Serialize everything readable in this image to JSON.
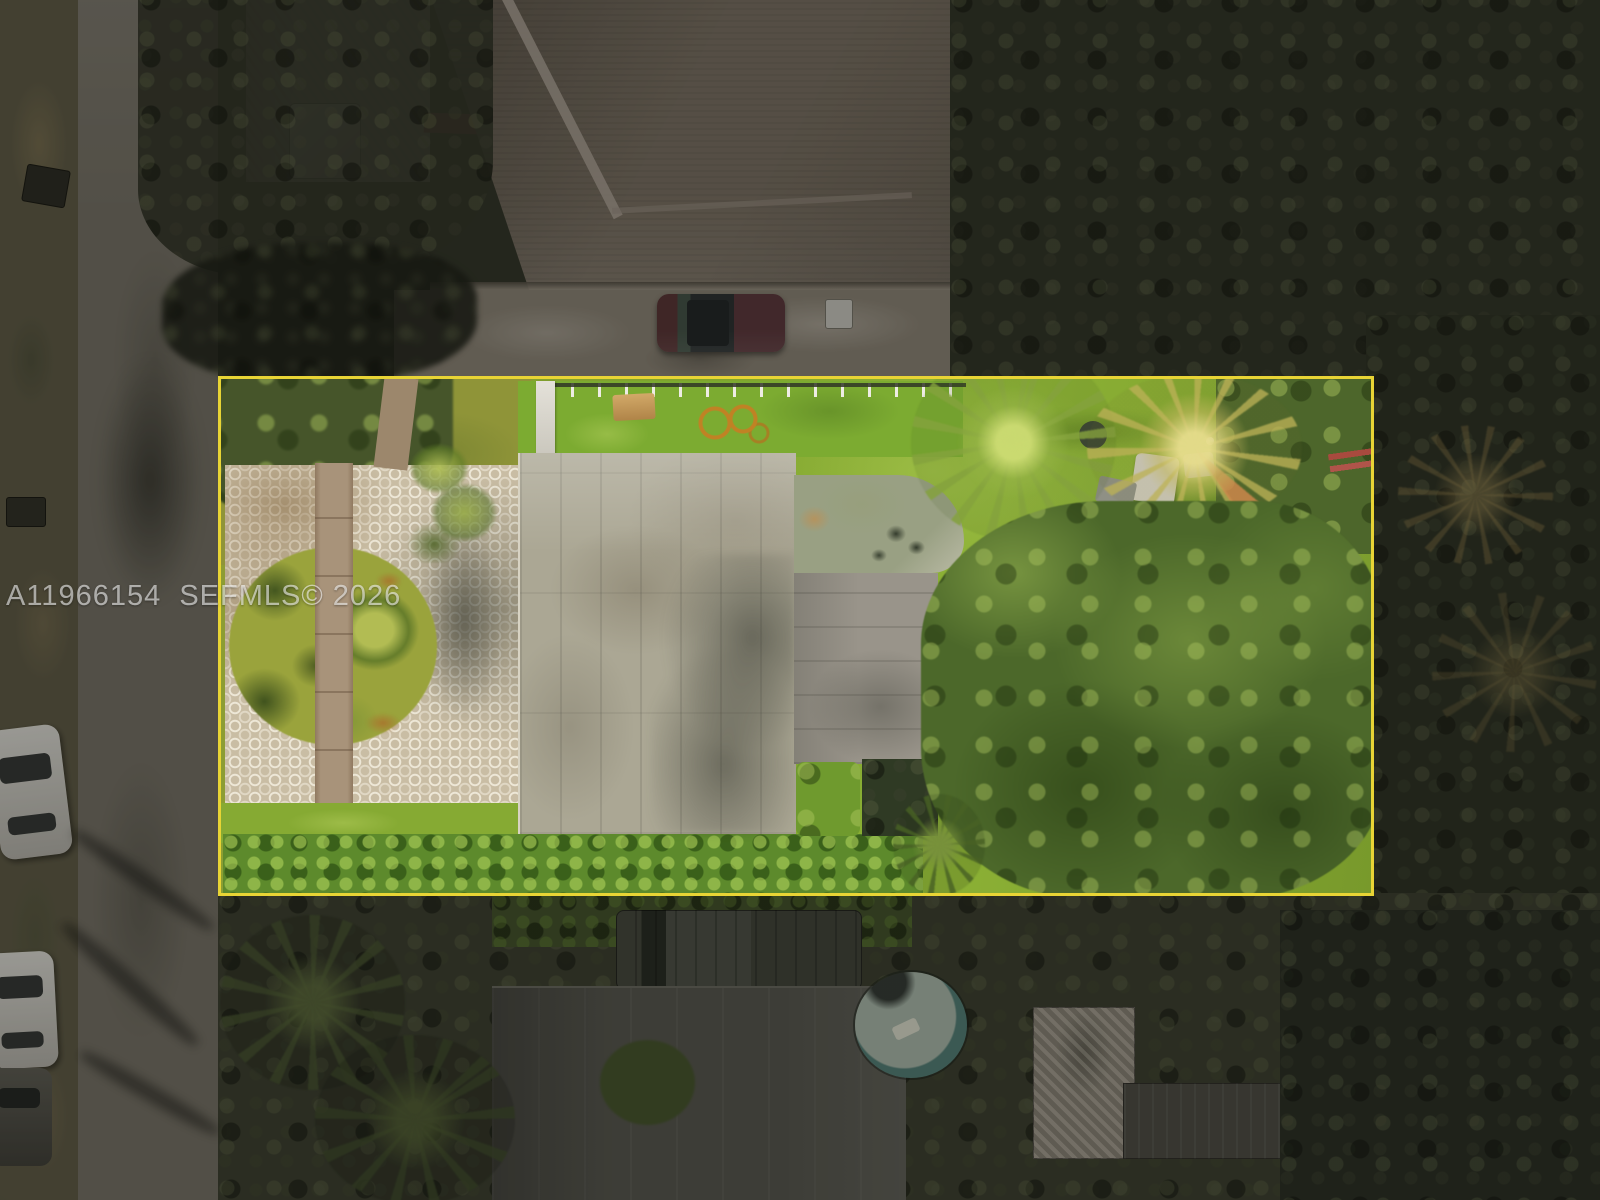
{
  "watermark": {
    "text": "A11966154  SEFMLS© 2026"
  },
  "palette": {
    "prop-line": "#e8d435",
    "watermark": "rgba(255,255,255,0.58)",
    "lawn": "#7fa42d",
    "canopy": "#4c682a",
    "island": "#9aa33c",
    "hedge": "#5d8a2c",
    "pavers": "#c9bda4",
    "walk": "#a8937a",
    "roof": "#aba794",
    "roof-shadow": "rgba(50,52,44,0.55)",
    "street": "#6a665c",
    "swale": "#56523f",
    "outside-trees": "#2b2e23",
    "top-roof": "#6e6559",
    "bottom-roof": "#4e4e47",
    "drive": "#7e776b",
    "suv": "#502e30",
    "car-white": "#c9c8c2",
    "pool-ring": "#2f4f4a",
    "pool-water": "#9aa89c",
    "hose": "#c48024",
    "picnic": "#d2a968",
    "gate": "#e4e1d9",
    "fence-post": "#eeece4",
    "palm-yellow": "rgba(185,175,85,0.8)",
    "rust": "rgba(172,106,42,0.75)"
  },
  "scene": {
    "type": "aerial-drone-photograph",
    "visible_objects": [
      "yellow property boundary outline",
      "circular hexagon-paver driveway with grass island",
      "front walkway",
      "flat concrete roof house",
      "rear patio pad with furniture",
      "white pool fence and gate",
      "picnic table",
      "coiled orange garden hose",
      "bright backyard lawn",
      "large tree canopy",
      "palm trees",
      "boundary hedge row",
      "residential street with parked cars",
      "trash bins",
      "neighbor hip-roof house",
      "dark red SUV in neighbor driveway",
      "pickup truck",
      "above-ground round pool with raft",
      "neighbor flat roofs",
      "dense surrounding vegetation"
    ]
  }
}
